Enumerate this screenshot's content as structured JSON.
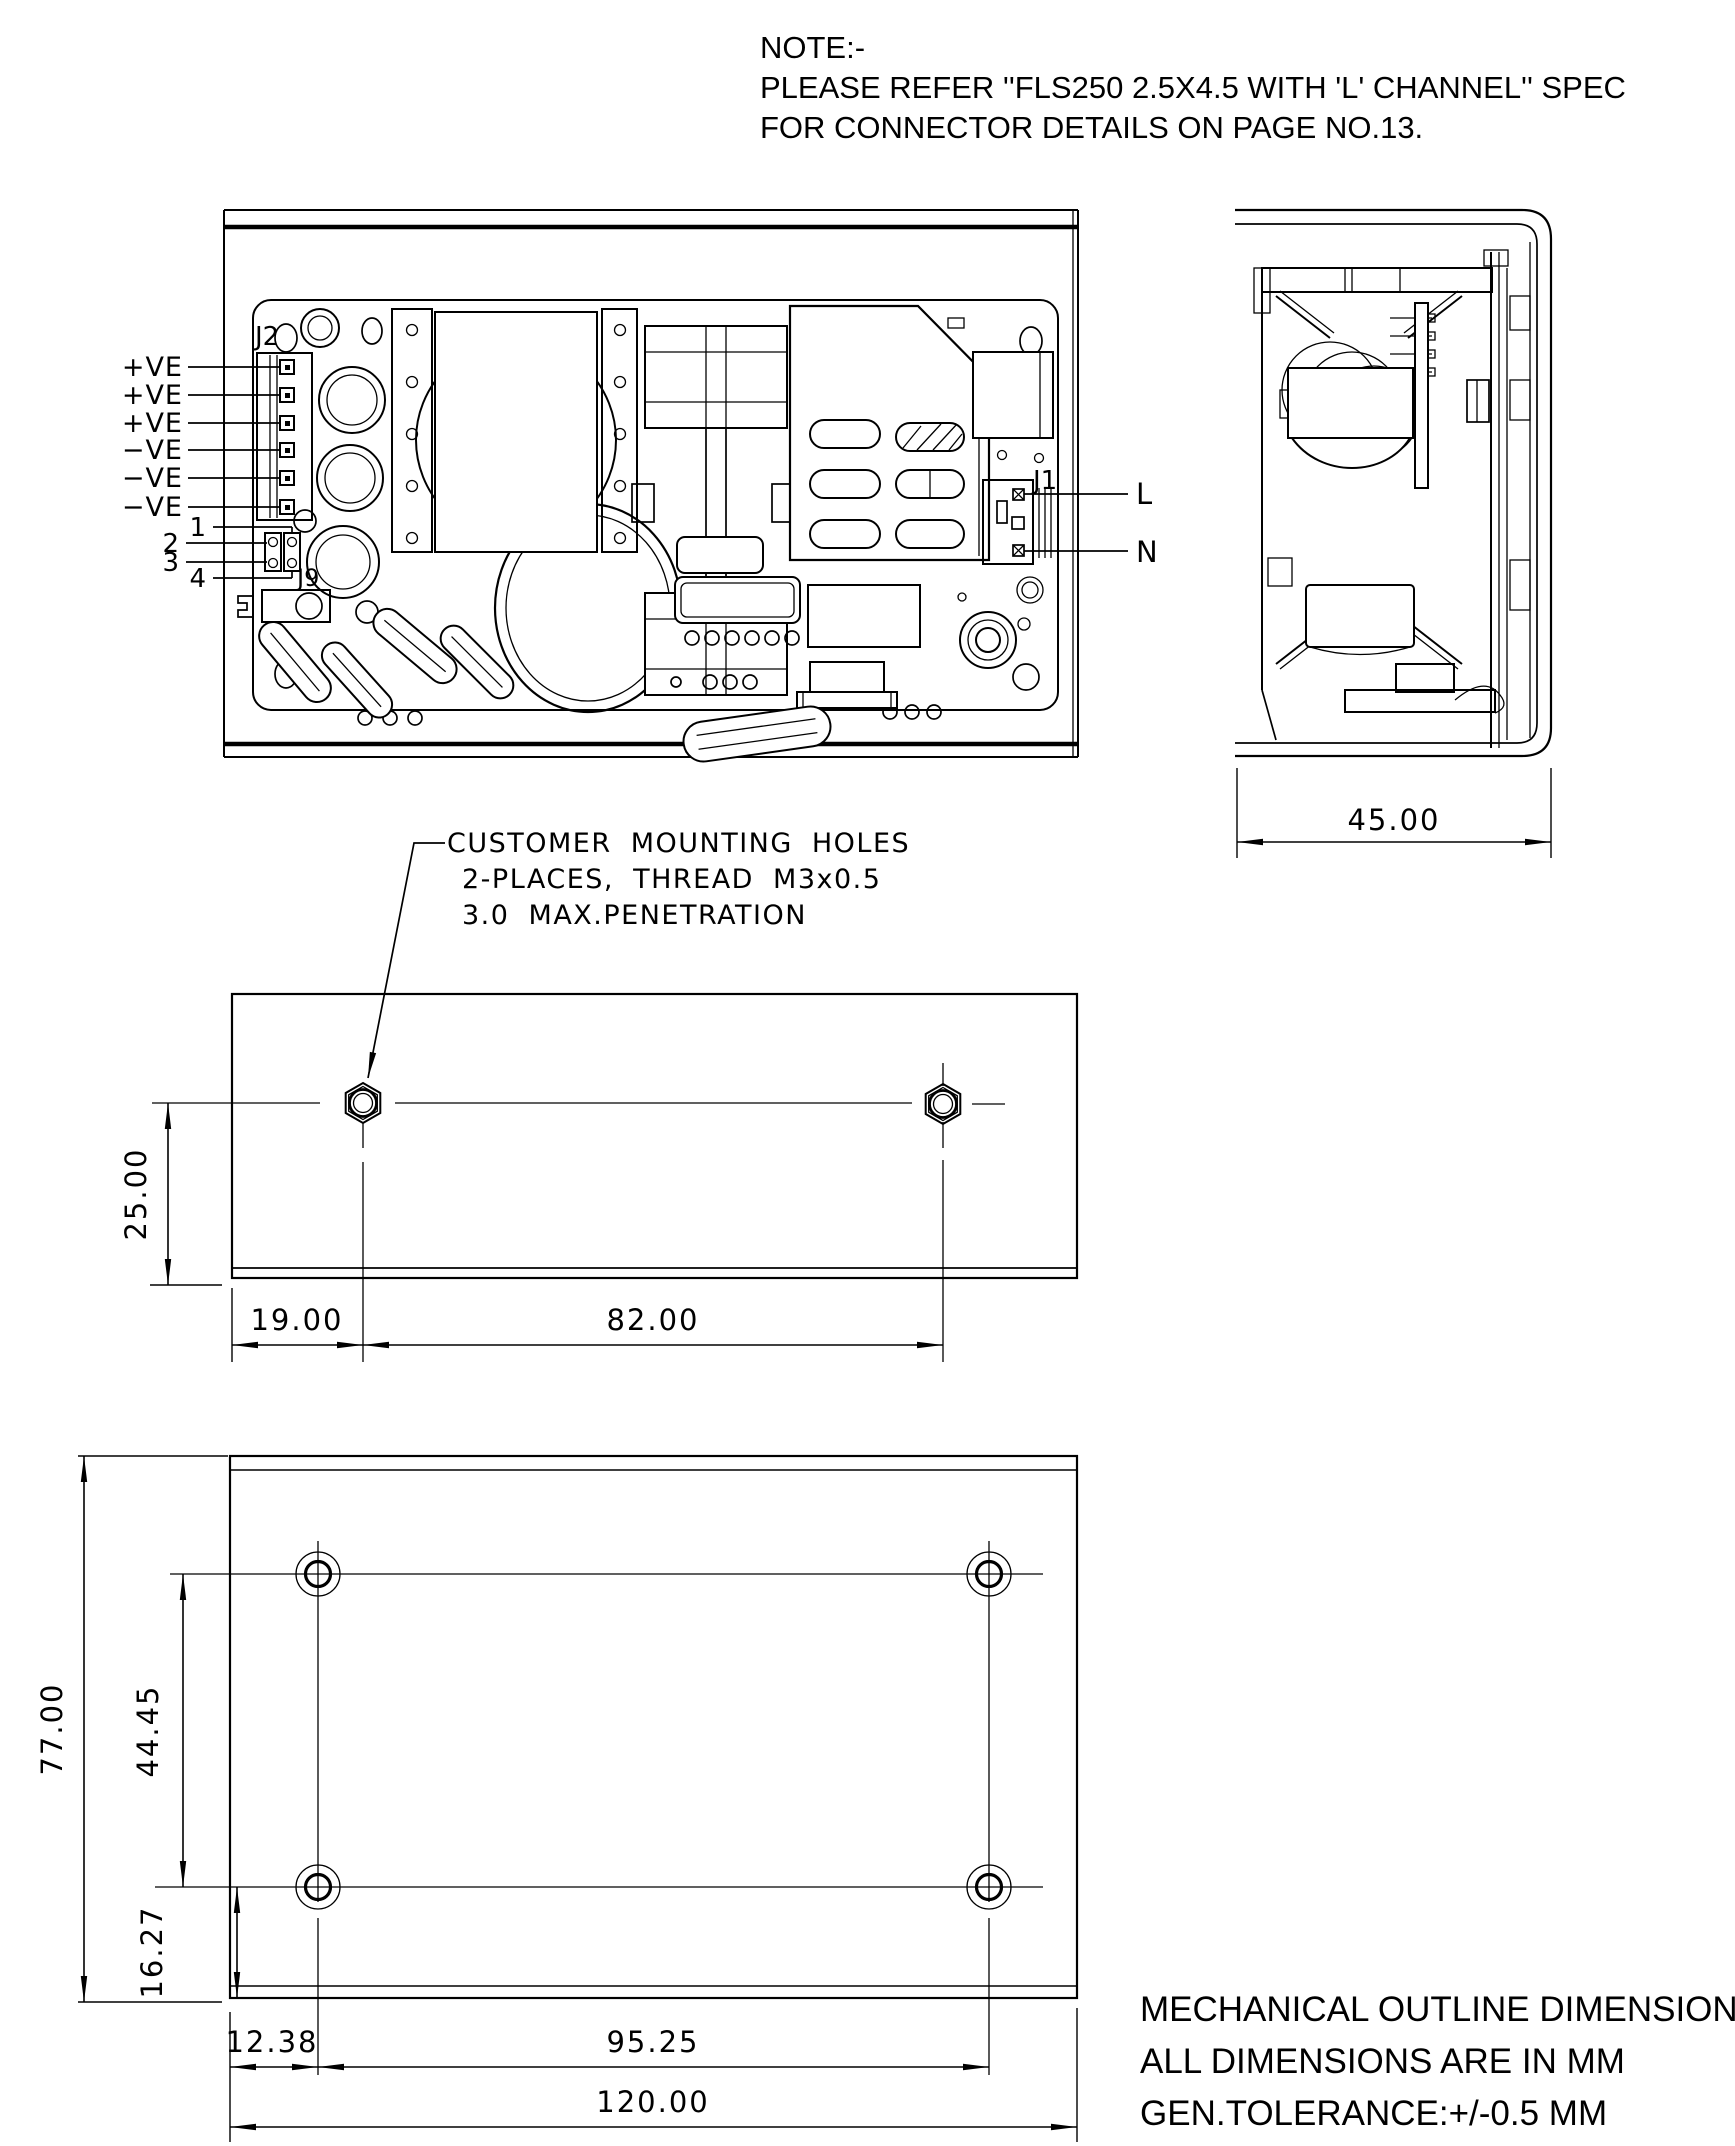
{
  "colors": {
    "ink": "#000000",
    "background": "#ffffff"
  },
  "note": {
    "title": "NOTE:-",
    "line1": "PLEASE REFER ''FLS250 2.5X4.5 WITH 'L' CHANNEL'' SPEC",
    "line2": "FOR CONNECTOR DETAILS ON PAGE NO.13."
  },
  "top_view": {
    "connector_j2_label": "J2",
    "connector_j1_label": "J1",
    "connector_j9_label": "J9",
    "output_pins": [
      "+VE",
      "+VE",
      "+VE",
      "−VE",
      "−VE",
      "−VE"
    ],
    "aux_pins": [
      "1",
      "2",
      "3",
      "4"
    ],
    "line_label": "L",
    "neutral_label": "N"
  },
  "side_view": {
    "width_dim": "45.00"
  },
  "mounting_note": {
    "line1": "CUSTOMER MOUNTING HOLES",
    "line2": "2-PLACES, THREAD M3x0.5",
    "line3": "3.0 MAX.PENETRATION"
  },
  "middle_view": {
    "dim_height": "25.00",
    "dim_left": "19.00",
    "dim_span": "82.00"
  },
  "bottom_view": {
    "dim_height": "77.00",
    "dim_rows": "44.45",
    "dim_bottom": "16.27",
    "dim_left": "12.38",
    "dim_span": "95.25",
    "dim_width": "120.00"
  },
  "footer": {
    "line1": "MECHANICAL OUTLINE DIMENSIONS",
    "line2": "ALL DIMENSIONS ARE IN MM",
    "line3": "GEN.TOLERANCE:+/-0.5 MM"
  }
}
